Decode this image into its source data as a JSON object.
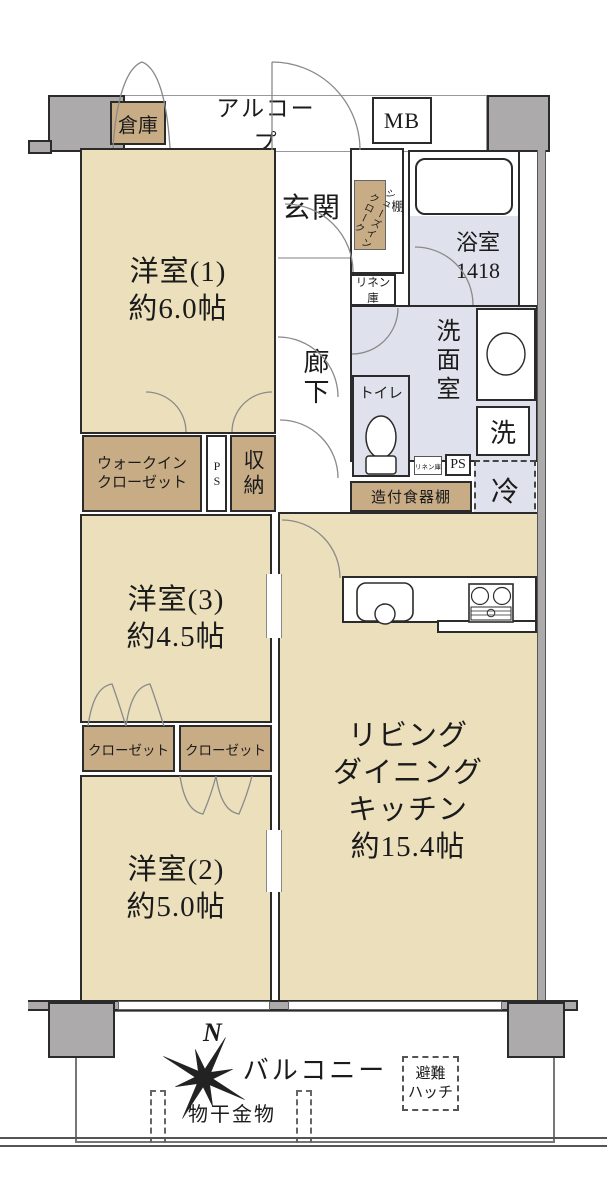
{
  "colors": {
    "room_beige": "#EBDFBC",
    "closet_tan": "#C8AC85",
    "wet_blue": "#DFE2EC",
    "wall_gray": "#ACAAAB",
    "outline": "#2b2b2b"
  },
  "top": {
    "storage": "倉庫",
    "alcove": "アルコープ",
    "mb": "MB"
  },
  "entry": {
    "genkan": "玄関",
    "corridor": "廊下",
    "sic1": "シューズイン",
    "sic2": "クローク",
    "shelf": "棚",
    "linen": "リネン庫"
  },
  "wet": {
    "bath": "浴室",
    "bath_size": "1418",
    "washroom": "洗面室",
    "washer": "洗",
    "toilet": "トイレ",
    "linen_small": "リネン庫",
    "ps": "PS",
    "fridge": "冷"
  },
  "kitchen": {
    "cupboard": "造付食器棚"
  },
  "storage": {
    "wic1": "ウォークイン",
    "wic2": "クローゼット",
    "ps": "PS",
    "shuno": "収納",
    "closet_l": "クローゼット",
    "closet_r": "クローゼット"
  },
  "rooms": {
    "r1_name": "洋室(1)",
    "r1_size": "約6.0帖",
    "r3_name": "洋室(3)",
    "r3_size": "約4.5帖",
    "r2_name": "洋室(2)",
    "r2_size": "約5.0帖",
    "ldk1": "リビング",
    "ldk2": "ダイニング",
    "ldk3": "キッチン",
    "ldk_size": "約15.4帖"
  },
  "balcony": {
    "label": "バルコニー",
    "north": "N",
    "laundry": "物干金物",
    "hatch1": "避難",
    "hatch2": "ハッチ"
  }
}
